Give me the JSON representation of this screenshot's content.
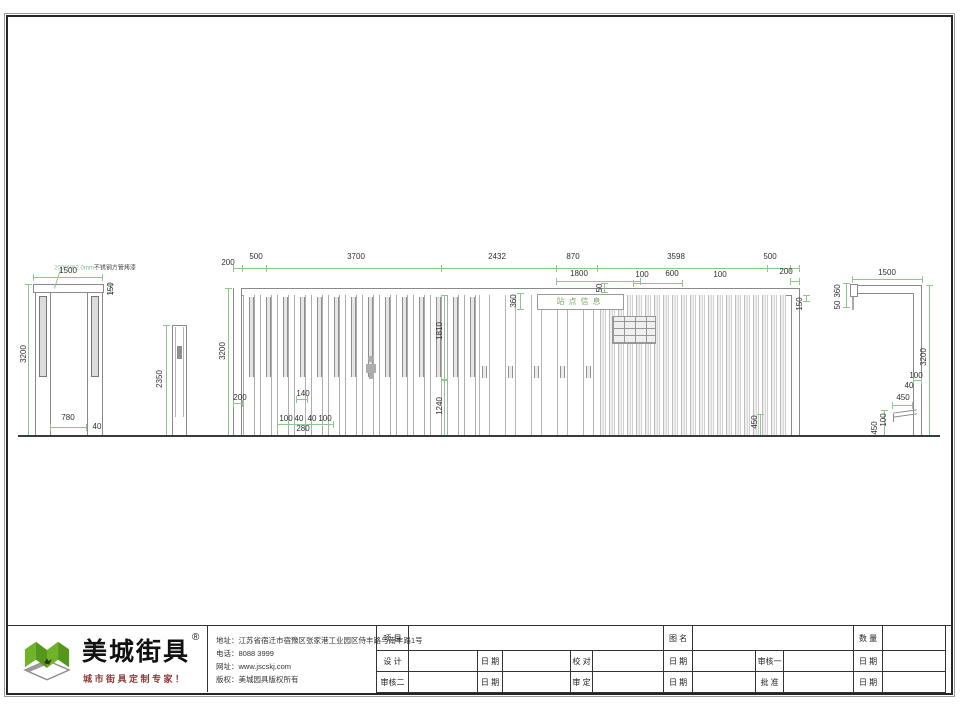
{
  "sheet": {
    "watermark": {
      "brand": "美城街具",
      "registered": "R",
      "tagline": "城市街具定制专家！"
    },
    "company": {
      "brand": "美城街具",
      "registered": "®",
      "slogan": "城市街具定制专家！",
      "address": "地址：江苏省宿迁市宿豫区张家港工业园区侍丰路与南丰路1号",
      "phone": "电话：8088 3999",
      "website": "网址：www.jscskj.com",
      "copyright": "版权：美城园具版权所有"
    },
    "table": {
      "row1": {
        "project": "项 目",
        "drawing_name": "图 名",
        "quantity": "数 量"
      },
      "row2": {
        "design": "设 计",
        "date1": "日 期",
        "check": "校 对",
        "date2": "日 期",
        "review1": "审核一",
        "date3": "日 期"
      },
      "row3": {
        "review2": "审核二",
        "date1": "日 期",
        "approve": "审 定",
        "date2": "日 期",
        "ratify": "批 准",
        "date3": "日 期"
      }
    }
  },
  "views": {
    "left": {
      "note_spec": "200*60*2.0mm",
      "note_material": "不锈钢方管烤漆",
      "width": "1500",
      "cap": "150",
      "height": "3200",
      "opening": "780",
      "post": "40"
    },
    "post": {
      "height": "2350"
    },
    "main": {
      "top_dims": [
        "200",
        "500",
        "3700",
        "2432",
        "870",
        "3598",
        "500"
      ],
      "sub_dims": [
        "1800",
        "100",
        "600",
        "100",
        "200"
      ],
      "sign": "站点信息",
      "inner": {
        "height": "3200",
        "d200": "200",
        "d140": "140",
        "d100a": "100",
        "d40a": "40",
        "d40b": "40",
        "d100b": "100",
        "d280": "280",
        "d1810": "1810",
        "d1240": "1240",
        "d360": "360",
        "d50": "50",
        "d150": "150",
        "d450": "450"
      }
    },
    "right": {
      "width": "1500",
      "d360": "360",
      "d50": "50",
      "height": "3200",
      "d100a": "100",
      "d40": "40",
      "d450a": "450",
      "d100b": "100",
      "d450b": "450"
    }
  },
  "colors": {
    "dim_line": "#8cc88c",
    "dim_text": "#2f2f2f",
    "outline": "#8a8a8a",
    "watermark_gray": "#cbcbcb",
    "watermark_green": "#a4bf83",
    "logo_green": "#6fb32a",
    "slogan_red": "#8b3a3a"
  }
}
